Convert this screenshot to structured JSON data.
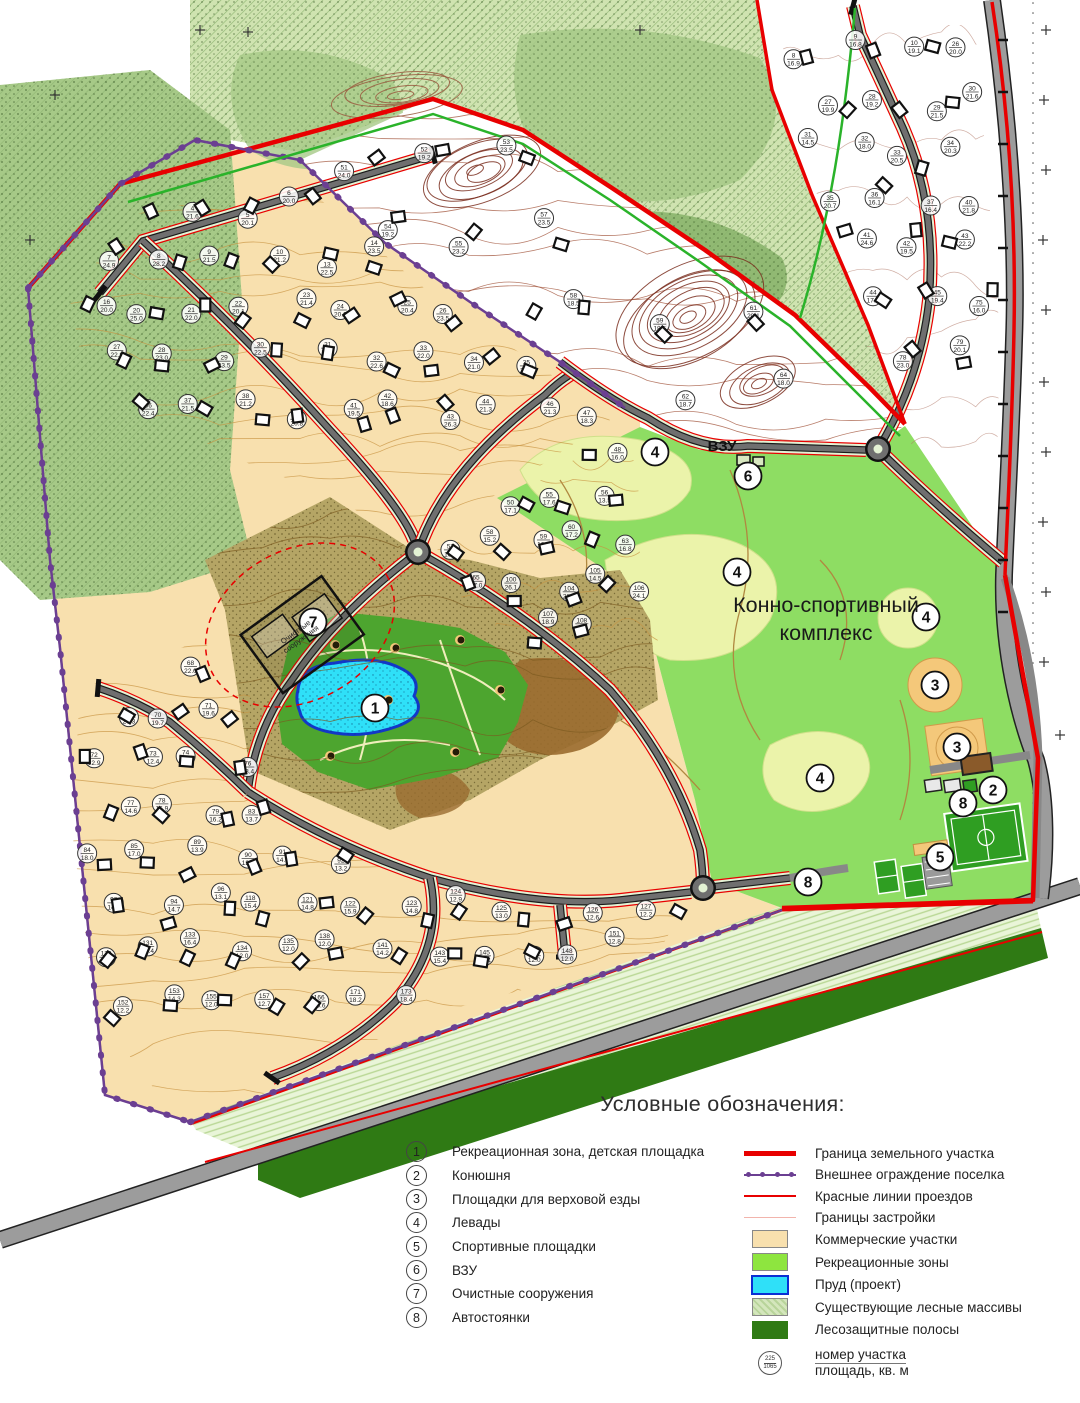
{
  "map": {
    "labels": {
      "complex_line1": "Конно-спортивный",
      "complex_line2": "комплекс",
      "vzu": "ВЗУ",
      "treatment_line1": "Очистные",
      "treatment_line2": "сооружения"
    },
    "markers": [
      {
        "n": "7",
        "x": 313,
        "y": 622
      },
      {
        "n": "1",
        "x": 375,
        "y": 708
      },
      {
        "n": "6",
        "x": 748,
        "y": 476
      },
      {
        "n": "4",
        "x": 655,
        "y": 452
      },
      {
        "n": "4",
        "x": 737,
        "y": 572
      },
      {
        "n": "4",
        "x": 926,
        "y": 617
      },
      {
        "n": "4",
        "x": 820,
        "y": 778
      },
      {
        "n": "3",
        "x": 935,
        "y": 685
      },
      {
        "n": "3",
        "x": 957,
        "y": 747
      },
      {
        "n": "2",
        "x": 993,
        "y": 790
      },
      {
        "n": "8",
        "x": 963,
        "y": 803
      },
      {
        "n": "8",
        "x": 808,
        "y": 882
      },
      {
        "n": "5",
        "x": 940,
        "y": 857
      }
    ],
    "parcels": {
      "upper": [
        "4|21.6",
        "5|20.1",
        "6|20.0",
        "7|24.9",
        "8|28.2",
        "9|21.5",
        "10|21.2",
        "13|22.5",
        "14|23.5",
        "16|20.0",
        "20|25.0",
        "21|22.0",
        "22|20.1",
        "23|21.4",
        "24|20.6",
        "25|20.4",
        "26|23.5",
        "27|22.9",
        "28|23.0",
        "29|23.5",
        "30|22.5",
        "31|22.5",
        "32|22.6",
        "33|22.0",
        "34|21.0",
        "35|22.4",
        "36|22.4",
        "37|21.5",
        "38|21.2",
        "40|20.8",
        "41|19.5",
        "42|18.6",
        "43|26.3",
        "44|21.3",
        "46|21.3",
        "47|18.3"
      ],
      "ravine": [
        "51|24.0",
        "52|19.2",
        "53|23.5",
        "54|19.2",
        "55|23.2",
        "57|23.5",
        "58|18.5",
        "59|18.5",
        "61|20.1",
        "62|18.7",
        "64|18.0"
      ],
      "central": [
        "48|16.0",
        "50|17.1",
        "55|17.6",
        "56|13.5",
        "57|16.0",
        "58|15.2",
        "59|16.8",
        "60|17.2",
        "63|16.8",
        "65|17.0",
        "100|26.1",
        "104|28.5",
        "105|14.5",
        "106|24.1",
        "107|18.9",
        "108|18.1"
      ],
      "lower": [
        "68|22.0",
        "69|20.3",
        "70|19.7",
        "71|19.6",
        "72|12.9",
        "73|12.4",
        "74|12.7",
        "76|13.4",
        "77|14.6",
        "78|16.9",
        "79|16.2",
        "83|13.7",
        "84|18.0",
        "85|17.0",
        "89|13.9",
        "90|13.9",
        "91|14.6",
        "92|13.2",
        "93|14.3",
        "94|14.7",
        "96|13.1",
        "118|15.4",
        "121|14.8",
        "122|15.9",
        "123|14.8",
        "124|12.9",
        "125|13.0",
        "126|12.6",
        "127|12.2",
        "129|12.6",
        "131|12.4",
        "133|16.4",
        "134|12.0",
        "135|12.0",
        "138|12.0",
        "141|14.2",
        "143|15.4",
        "145|12.4",
        "147|12.0",
        "148|12.0",
        "151|12.8",
        "152|12.2",
        "153|14.3",
        "155|12.0",
        "157|12.7",
        "166|15.6",
        "171|18.2",
        "173|18.4"
      ],
      "right": [
        "8|16.9",
        "9|16.8",
        "10|19.1",
        "26|20.0",
        "27|19.9",
        "28|19.2",
        "29|21.5",
        "30|21.6",
        "31|14.5",
        "32|18.0",
        "33|20.5",
        "34|20.3",
        "35|20.7",
        "36|16.1",
        "37|16.4",
        "40|21.8",
        "41|24.6",
        "42|19.5",
        "43|22.2",
        "44|17.9",
        "45|19.4",
        "75|16.0",
        "78|23.0",
        "79|20.1"
      ]
    }
  },
  "legend": {
    "title": "Условные обозначения:",
    "items_numbered": [
      {
        "num": "1",
        "label": "Рекреационная зона, детская площадка"
      },
      {
        "num": "2",
        "label": "Конюшня"
      },
      {
        "num": "3",
        "label": "Площадки для верховой езды"
      },
      {
        "num": "4",
        "label": "Левады"
      },
      {
        "num": "5",
        "label": "Спортивные площадки"
      },
      {
        "num": "6",
        "label": "ВЗУ"
      },
      {
        "num": "7",
        "label": "Очистные сооружения"
      },
      {
        "num": "8",
        "label": "Автостоянки"
      }
    ],
    "items_symbols": [
      {
        "type": "line-thick-red",
        "label": "Граница земельного участка"
      },
      {
        "type": "line-purple-dots",
        "label": "Внешнее ограждение поселка"
      },
      {
        "type": "line-red",
        "label": "Красные линии проездов"
      },
      {
        "type": "line-pink",
        "label": "Границы застройки"
      },
      {
        "type": "swatch-tan",
        "label": "Коммерческие участки"
      },
      {
        "type": "swatch-green",
        "label": "Рекреационные зоны"
      },
      {
        "type": "swatch-pond",
        "label": "Пруд (проект)"
      },
      {
        "type": "swatch-forest",
        "label": "Существующие лесные массивы"
      },
      {
        "type": "swatch-darkgreen",
        "label": "Лесозащитные полосы"
      }
    ],
    "parcel_symbol": {
      "top": "225",
      "bottom": "1065",
      "label_line1": "номер участка",
      "label_line2": "площадь, кв. м"
    }
  },
  "colors": {
    "red": "#e80000",
    "purple": "#6b3f92",
    "pink": "#f2b4ac",
    "tan": "#f8e0ae",
    "tan_line": "#c8923e",
    "forest_light": "#cfe3b0",
    "forest_mid": "#a6c987",
    "forest_dark": "#86b268",
    "complex_green": "#8edd63",
    "levada": "#ebf3aa",
    "rec_green": "#4da52f",
    "pond": "#2fe0f8",
    "pond_border": "#1238c8",
    "orange": "#f4c87a",
    "road": "#6f6f6f",
    "road_casing": "#1a1a1a",
    "verge": "#e4f2d4",
    "highway": "#9c9c9c",
    "strip_dark": "#2f7a14",
    "strip_light": "#e9f5d8",
    "hill": "#b5a565",
    "ravine": "#7a2e1e",
    "green_line": "#2ab32a",
    "field_green": "#2f9e22",
    "stable_brown": "#8a5a2a"
  }
}
